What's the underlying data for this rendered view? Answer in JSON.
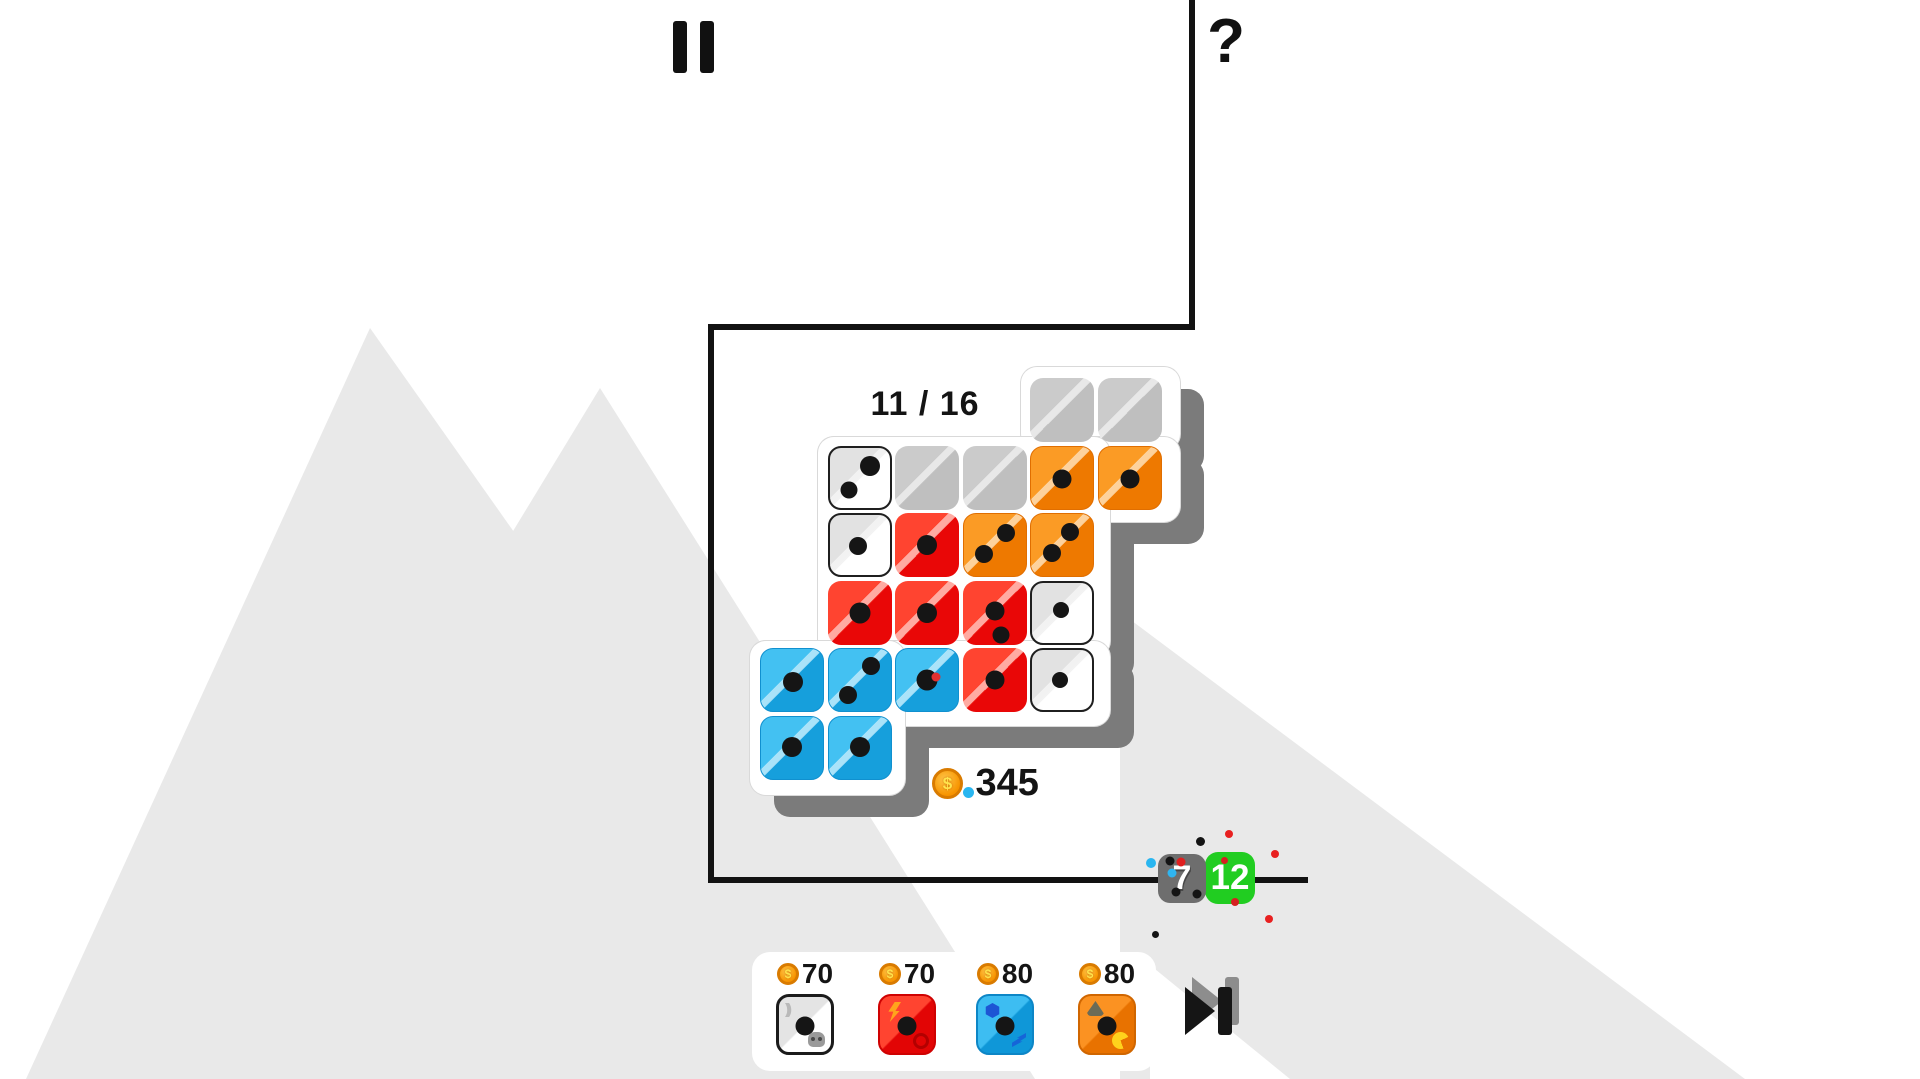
{
  "hud": {
    "pause_label": "pause",
    "help_label": "?"
  },
  "board": {
    "counter": "11 / 16",
    "grid": {
      "x0": 760,
      "y0": 378,
      "pitch": 67.6,
      "tile": 64
    },
    "tiles": [
      {
        "r": 0,
        "c": 4,
        "color": "gray",
        "pips": []
      },
      {
        "r": 0,
        "c": 5,
        "color": "gray",
        "pips": []
      },
      {
        "r": 1,
        "c": 1,
        "color": "white",
        "pips": [
          [
            68,
            30,
            20
          ],
          [
            33,
            70,
            17
          ]
        ]
      },
      {
        "r": 1,
        "c": 2,
        "color": "gray",
        "pips": []
      },
      {
        "r": 1,
        "c": 3,
        "color": "gray",
        "pips": []
      },
      {
        "r": 1,
        "c": 4,
        "color": "orange",
        "pips": [
          [
            50,
            52,
            19
          ]
        ]
      },
      {
        "r": 1,
        "c": 5,
        "color": "orange",
        "pips": [
          [
            50,
            52,
            19
          ]
        ]
      },
      {
        "r": 2,
        "c": 1,
        "color": "white",
        "pips": [
          [
            48,
            52,
            18
          ]
        ]
      },
      {
        "r": 2,
        "c": 2,
        "color": "red",
        "pips": [
          [
            50,
            50,
            20
          ]
        ]
      },
      {
        "r": 2,
        "c": 3,
        "color": "orange",
        "pips": [
          [
            68,
            30,
            18
          ],
          [
            33,
            64,
            18
          ]
        ]
      },
      {
        "r": 2,
        "c": 4,
        "color": "orange",
        "pips": [
          [
            63,
            29,
            18
          ],
          [
            33,
            63,
            18
          ]
        ]
      },
      {
        "r": 3,
        "c": 1,
        "color": "red",
        "pips": [
          [
            50,
            50,
            21
          ]
        ]
      },
      {
        "r": 3,
        "c": 2,
        "color": "red",
        "pips": [
          [
            50,
            50,
            20
          ]
        ]
      },
      {
        "r": 3,
        "c": 3,
        "color": "red",
        "pips": [
          [
            50,
            47,
            19
          ],
          [
            60,
            85,
            17
          ]
        ]
      },
      {
        "r": 3,
        "c": 4,
        "color": "white",
        "pips": [
          [
            47,
            46,
            16
          ]
        ]
      },
      {
        "r": 4,
        "c": 0,
        "color": "blue",
        "pips": [
          [
            51,
            52,
            20
          ]
        ]
      },
      {
        "r": 4,
        "c": 1,
        "color": "blue",
        "pips": [
          [
            69,
            27,
            18
          ],
          [
            32,
            73,
            18
          ]
        ]
      },
      {
        "r": 4,
        "c": 2,
        "color": "blue",
        "pips": [
          [
            50,
            50,
            21
          ],
          [
            65,
            44,
            9,
            "#e03131"
          ]
        ]
      },
      {
        "r": 4,
        "c": 3,
        "color": "red",
        "pips": [
          [
            50,
            50,
            19
          ]
        ]
      },
      {
        "r": 4,
        "c": 4,
        "color": "white",
        "pips": [
          [
            46,
            50,
            16
          ]
        ]
      },
      {
        "r": 5,
        "c": 0,
        "color": "blue",
        "pips": [
          [
            50,
            48,
            20
          ]
        ]
      },
      {
        "r": 5,
        "c": 1,
        "color": "blue",
        "pips": [
          [
            50,
            48,
            20
          ]
        ]
      }
    ]
  },
  "wallet": {
    "coin_symbol": "$",
    "coins": "345"
  },
  "round": {
    "die_value": "7",
    "score": "12"
  },
  "shop": {
    "items": [
      {
        "price": "70",
        "color": "white"
      },
      {
        "price": "70",
        "color": "red"
      },
      {
        "price": "80",
        "color": "blue"
      },
      {
        "price": "80",
        "color": "orange"
      }
    ]
  },
  "decor": {
    "die_badge_pips": [
      {
        "x": 24,
        "y": 15,
        "c": "#141414"
      },
      {
        "x": 48,
        "y": 16,
        "c": "#e02020"
      },
      {
        "x": 30,
        "y": 38,
        "c": "#2fb5f0"
      },
      {
        "x": 38,
        "y": 78,
        "c": "#141414"
      },
      {
        "x": 82,
        "y": 82,
        "c": "#141414"
      }
    ],
    "confetti": [
      {
        "x": 1196,
        "y": 837,
        "s": 9,
        "c": "#141414"
      },
      {
        "x": 1225,
        "y": 830,
        "s": 8,
        "c": "#e82020"
      },
      {
        "x": 1271,
        "y": 850,
        "s": 8,
        "c": "#e82020"
      },
      {
        "x": 1146,
        "y": 858,
        "s": 10,
        "c": "#29b6f0"
      },
      {
        "x": 1221,
        "y": 857,
        "s": 7,
        "c": "#d42020"
      },
      {
        "x": 1231,
        "y": 898,
        "s": 8,
        "c": "#d42020"
      },
      {
        "x": 1265,
        "y": 915,
        "s": 8,
        "c": "#e82020"
      },
      {
        "x": 1152,
        "y": 931,
        "s": 7,
        "c": "#141414"
      }
    ]
  },
  "colors": {
    "backdrop_gray": "#e9e9e9",
    "board_shadow": "#7b7b7b",
    "accent_green": "#21cd21",
    "accent_blue": "#169fdc",
    "accent_red": "#e90707",
    "accent_orange": "#ee7900",
    "coin_gold": "#f79400"
  }
}
